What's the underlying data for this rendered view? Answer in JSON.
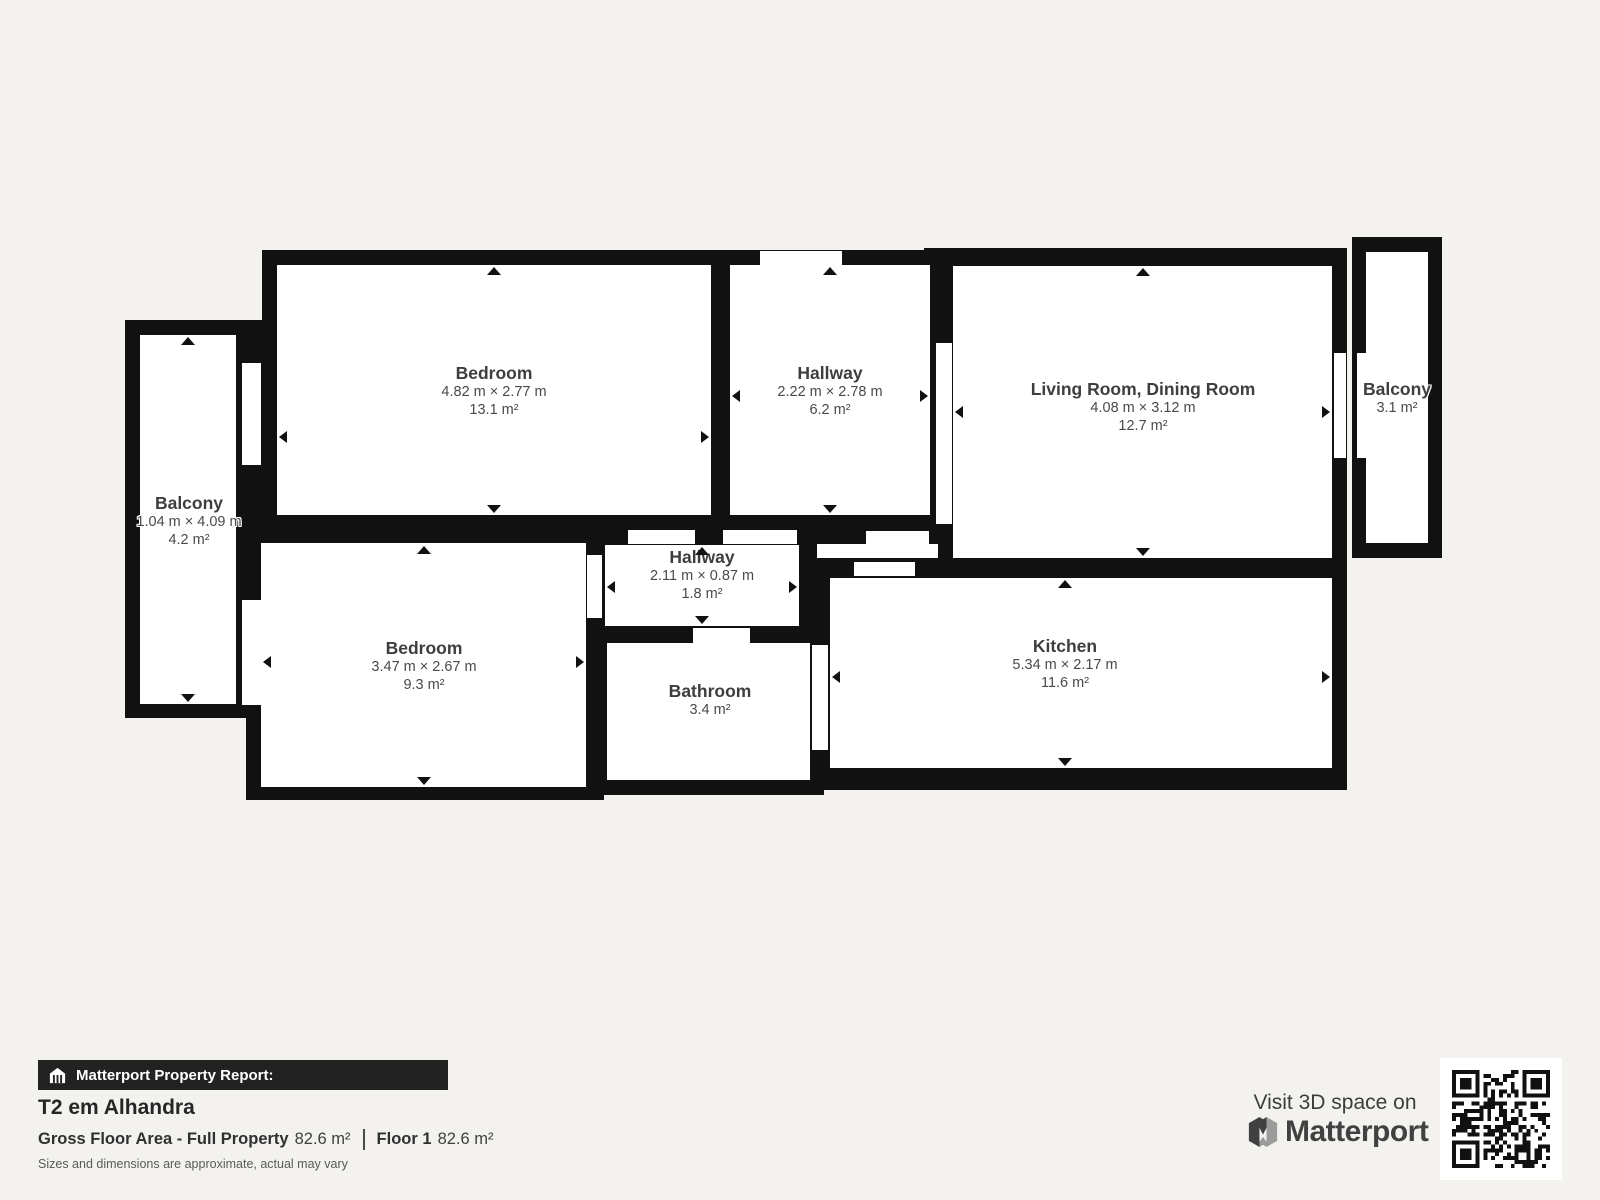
{
  "floorplan": {
    "rooms": [
      {
        "id": "bedroom-1",
        "name": "Bedroom",
        "dimensions": "4.82 m × 2.77 m",
        "area": "13.1 m²"
      },
      {
        "id": "hallway-top",
        "name": "Hallway",
        "dimensions": "2.22 m × 2.78 m",
        "area": "6.2 m²"
      },
      {
        "id": "living-dining",
        "name": "Living Room, Dining Room",
        "dimensions": "4.08 m × 3.12 m",
        "area": "12.7 m²"
      },
      {
        "id": "balcony-right",
        "name": "Balcony",
        "dimensions": "",
        "area": "3.1 m²"
      },
      {
        "id": "balcony-left",
        "name": "Balcony",
        "dimensions": "1.04 m × 4.09 m",
        "area": "4.2 m²"
      },
      {
        "id": "bedroom-2",
        "name": "Bedroom",
        "dimensions": "3.47 m × 2.67 m",
        "area": "9.3 m²"
      },
      {
        "id": "hallway-small",
        "name": "Hallway",
        "dimensions": "2.11 m × 0.87 m",
        "area": "1.8 m²"
      },
      {
        "id": "bathroom",
        "name": "Bathroom",
        "dimensions": "",
        "area": "3.4 m²"
      },
      {
        "id": "kitchen",
        "name": "Kitchen",
        "dimensions": "5.34 m × 2.17 m",
        "area": "11.6 m²"
      }
    ]
  },
  "footer": {
    "report_label": "Matterport Property Report:",
    "property_title": "T2 em Alhandra",
    "gross_floor_area_label": "Gross Floor Area - Full Property",
    "gross_floor_area_value": "82.6 m²",
    "floor_label": "Floor 1",
    "floor_value": "82.6 m²",
    "disclaimer": "Sizes and dimensions are approximate, actual may vary"
  },
  "promo": {
    "visit_text": "Visit 3D space on",
    "brand": "Matterport"
  },
  "icons": {
    "report_bar_icon": "building-icon",
    "brand_icon": "matterport-logo-icon",
    "qr": "qr-code"
  },
  "colors": {
    "background": "#f3f2ef",
    "wall": "#111111",
    "floor": "#ffffff",
    "label_primary": "#3e3e3e",
    "label_secondary": "#4a4a4a",
    "footer_bar_bg": "#222222",
    "footer_bar_text": "#ffffff"
  }
}
